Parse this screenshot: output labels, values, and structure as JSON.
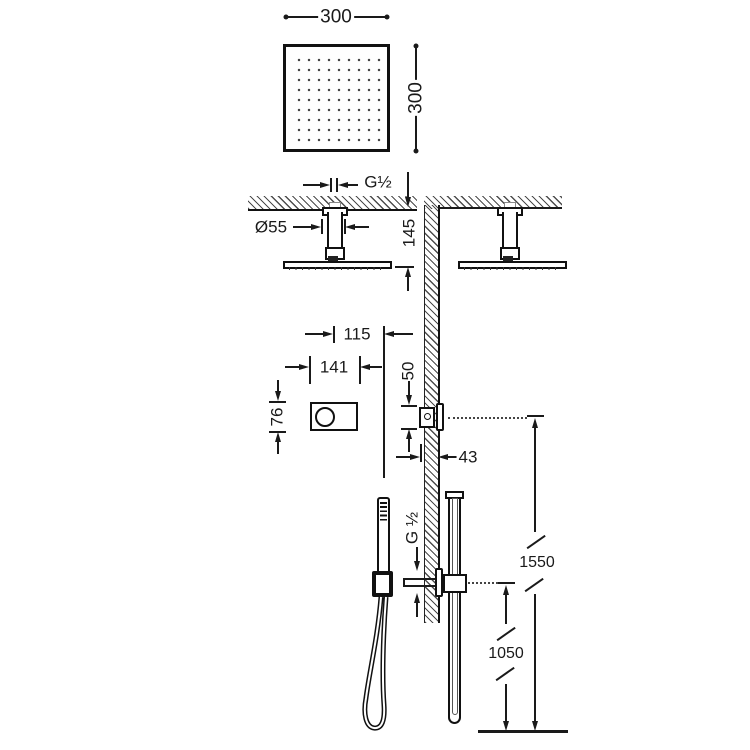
{
  "drawing": {
    "kind": "shower-system-installation-dimension-drawing",
    "colors": {
      "line": "#1a1a1a",
      "background": "#ffffff",
      "hatch": "#4d4d4d"
    }
  },
  "dims": {
    "head_width": "300",
    "head_depth": "300",
    "ceiling_thread": "G½",
    "rose_diameter": "Ø55",
    "head_drop": "145",
    "offset_arm_to_rail": "115",
    "control_plate_width": "141",
    "control_plate_height": "76",
    "control_body_height": "50",
    "recess_depth": "43",
    "outlet_thread": "G ½",
    "control_height_from_floor": "1550",
    "outlet_height_from_floor": "1050"
  }
}
